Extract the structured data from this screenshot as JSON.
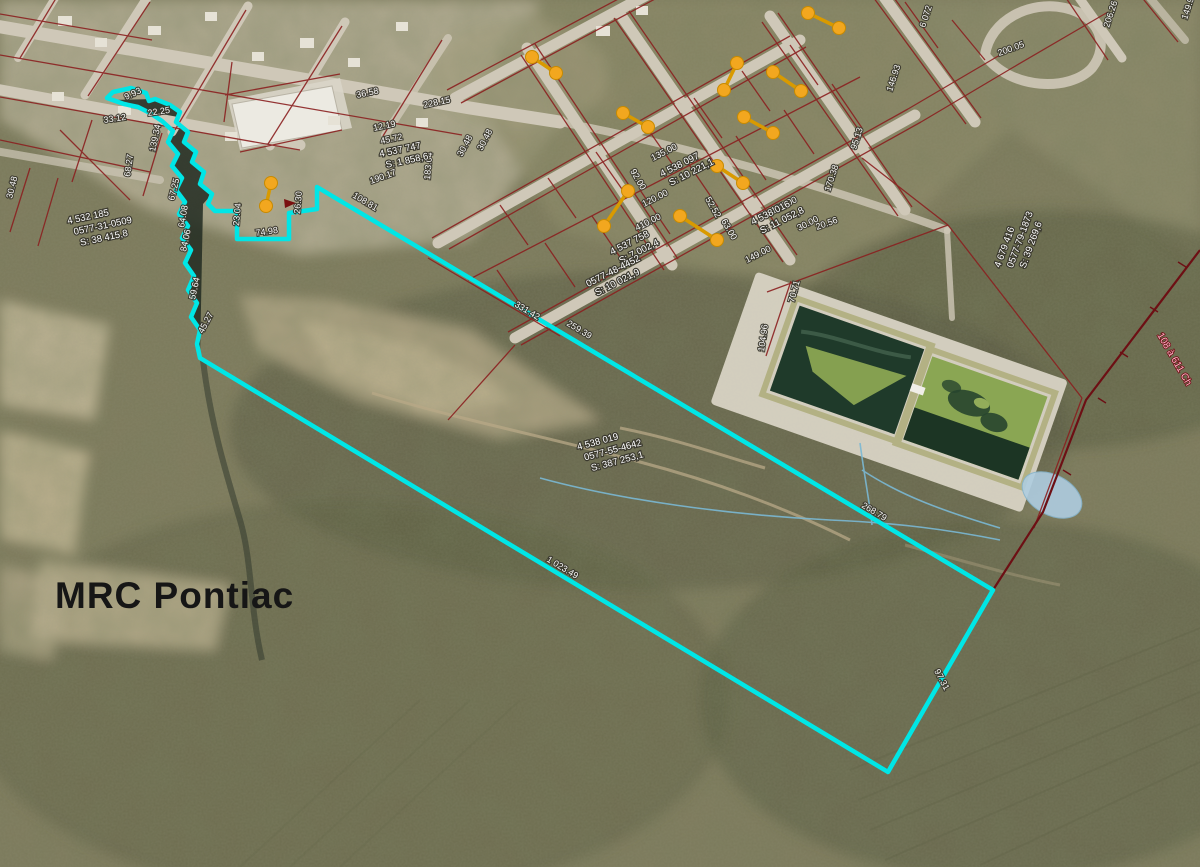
{
  "map": {
    "region_label": "MRC Pontiac",
    "road_label": "108 à 611 Ch",
    "selection_color": "#00E6E6",
    "cadastre_color": "#8B2020",
    "marker_color": "#F2A71F",
    "hydro_color": "#9CC7DF",
    "road_label_color": "#FFB3C8",
    "markers": {
      "count": 10
    },
    "parcels": [
      {
        "lot": "4 538 019",
        "matricule": "0577-55-4642",
        "area": "S: 387 253,1"
      },
      {
        "lot": "4 532 185",
        "matricule": "0577-31-0509",
        "area": "S: 38 415,8"
      },
      {
        "lot": "4 679 416",
        "matricule": "0577-79-1873",
        "area": "S: 39 269,6"
      },
      {
        "lot": "4 538 097",
        "area": "S: 10 221,1"
      },
      {
        "lot": "4 537 758",
        "area": "S: 7 002,4"
      },
      {
        "lot": "0577-48-4452",
        "area": "S: 10 021,9"
      },
      {
        "lot": "4 538 016",
        "area": "S: 11 052,8"
      },
      {
        "lot": "4 537 747",
        "area": "S: 1 858,6"
      }
    ],
    "dimensions": [
      "22.25",
      "33.12",
      "9.93",
      "139.34",
      "68.27",
      "67.25",
      "84.06",
      "59.64",
      "45.27",
      "26.30",
      "74.98",
      "23.04",
      "108.81",
      "331.42",
      "259.39",
      "268.79",
      "1 023.49",
      "97.31",
      "135.00",
      "120.00",
      "410.00",
      "149.00",
      "136.00",
      "92.00",
      "52.52",
      "63.00",
      "30.00",
      "6 072",
      "200.05",
      "206.26",
      "146.93",
      "95.13",
      "170.38",
      "20.56",
      "149.98",
      "228.15",
      "36.58",
      "30.48",
      "30.48",
      "183.04",
      "12.19",
      "45.72",
      "30.48",
      "70.71",
      "104.96",
      "64.08",
      "190.17"
    ]
  }
}
